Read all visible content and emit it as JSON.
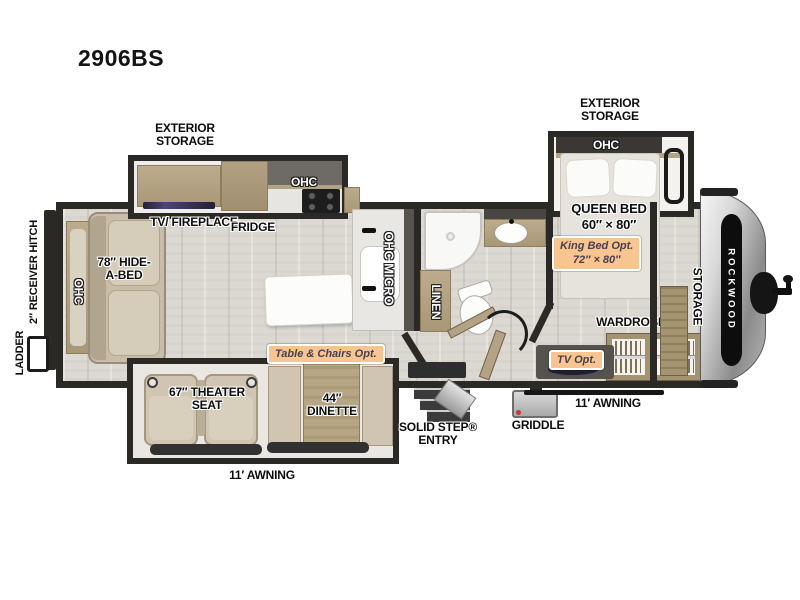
{
  "model": "2906BS",
  "colors": {
    "wall": "#2B2926",
    "floor": "#DCD8D2",
    "cabinet": "#B3A284",
    "sofa": "#C8BDA9",
    "badge_bg": "#F8C48F",
    "badge_text": "#474051",
    "front_cap": "#9B9B9B",
    "tv_glow": "#4E4380"
  },
  "labels": {
    "ladder": "LADDER",
    "receiver_hitch": "2″ RECEIVER HITCH",
    "rear_ohc": "OHC",
    "hide_a_bed": "78″ HIDE-A-BED",
    "exterior_storage_left": "EXTERIOR STORAGE",
    "tv_fireplace": "TV/ FIREPLACE",
    "fridge": "FRIDGE",
    "kitchen_ohc": "OHC",
    "ohc_micro": "OHC MICRO",
    "linen": "LINEN",
    "exterior_storage_right": "EXTERIOR STORAGE",
    "bed_ohc": "OHC",
    "queen_bed": "QUEEN BED",
    "queen_bed_size": "60″ × 80″",
    "king_opt_title": "King Bed Opt.",
    "king_opt_size": "72″ × 80″",
    "wardrobe": "WARDROBE",
    "tv_opt": "TV Opt.",
    "awning_right": "11′ AWNING",
    "griddle": "GRIDDLE",
    "solid_step": "SOLID STEP® ENTRY",
    "table_chairs_opt": "Table & Chairs Opt.",
    "dinette": "44″ DINETTE",
    "theater_seat": "67″ THEATER SEAT",
    "awning_bottom": "11′ AWNING",
    "front_storage": "STORAGE",
    "brand": "ROCKWOOD"
  }
}
